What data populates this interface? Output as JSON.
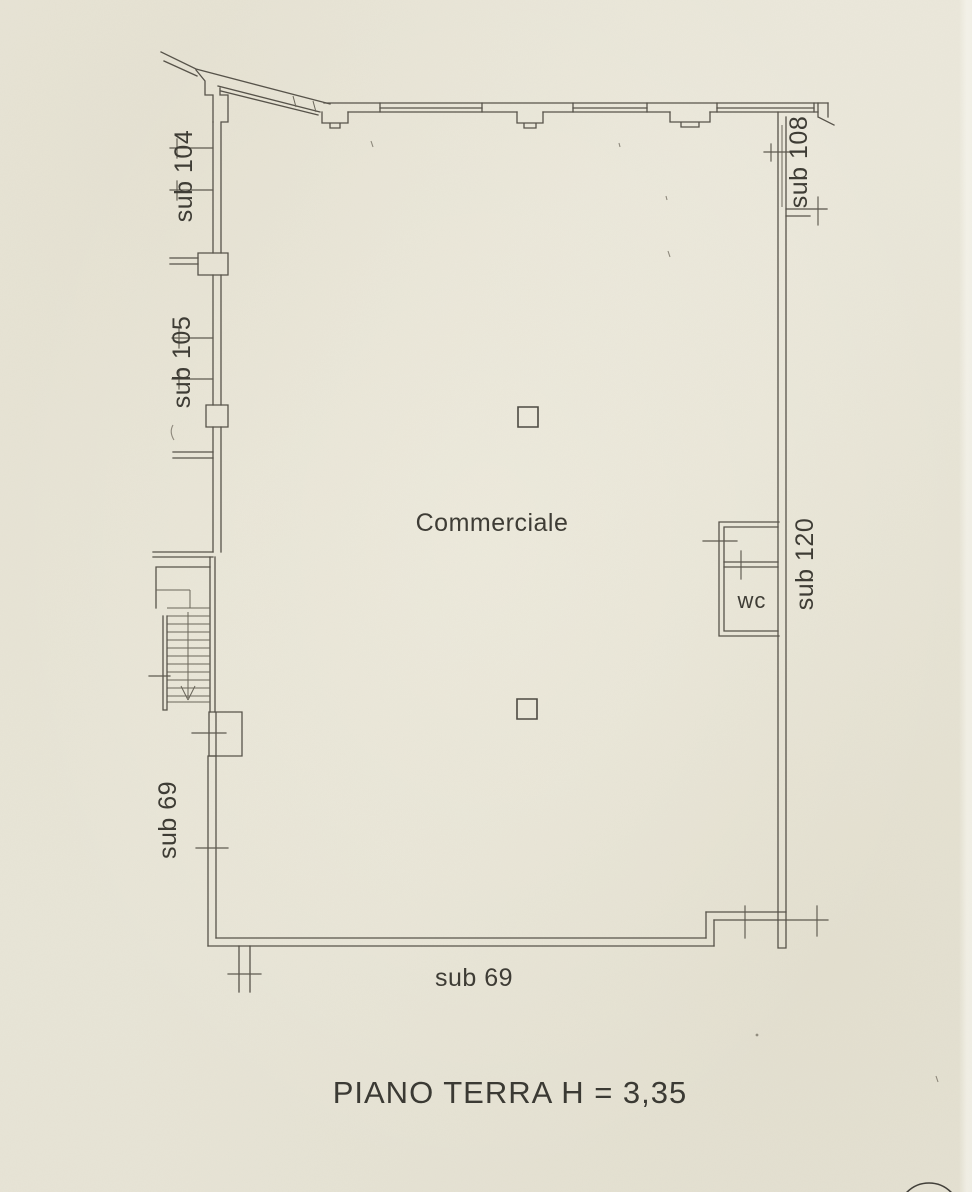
{
  "document": {
    "kind": "cadastral floor plan (scanned)",
    "caption": "PIANO TERRA H = 3,35"
  },
  "palette": {
    "paper": "#eae7da",
    "ink": "#57534a",
    "text": "#3e3c35"
  },
  "plan": {
    "room_label": "Commerciale",
    "wc_label": "wc",
    "subunit_labels": {
      "left_top": "sub 104",
      "left_middle": "sub 105",
      "right_top": "sub 108",
      "right_middle": "sub 120",
      "left_bottom": "sub 69",
      "bottom": "sub 69"
    }
  }
}
